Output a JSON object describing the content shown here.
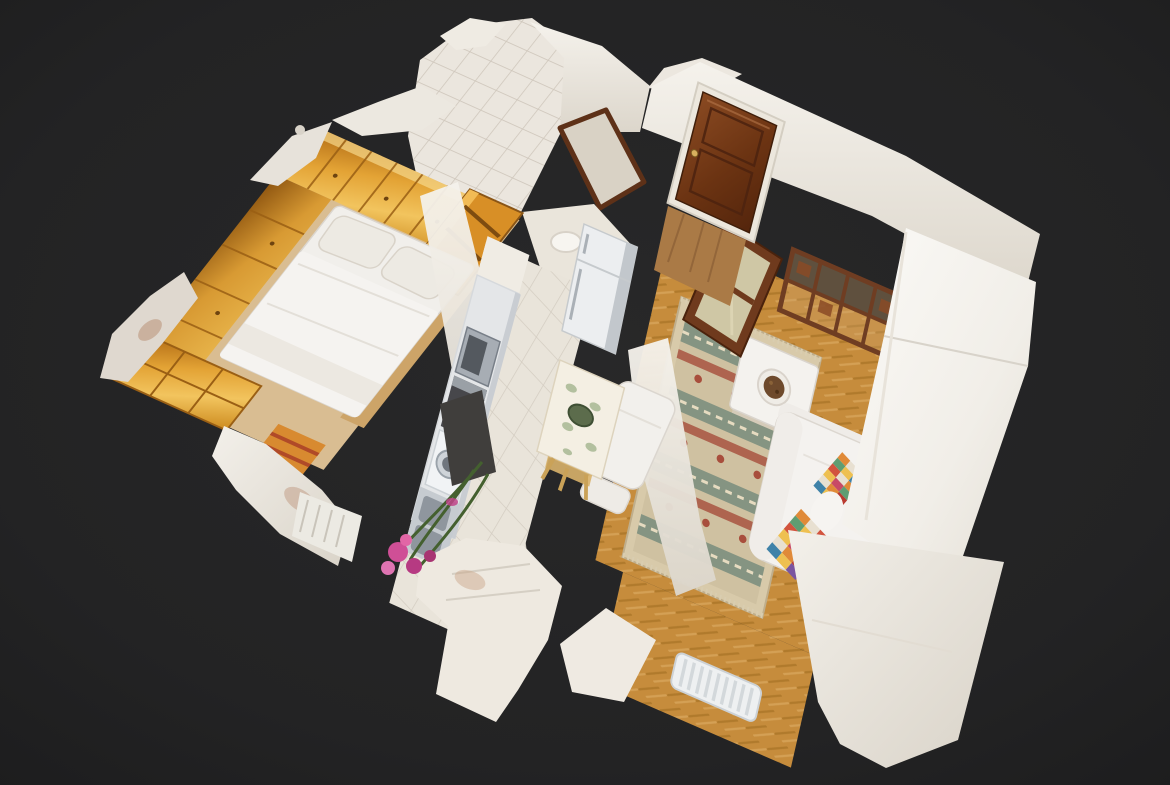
{
  "scene": {
    "aria_label": "3D dollhouse overhead view of a furnished one-bedroom apartment on a dark background",
    "view_mode": "dollhouse-3d",
    "background_color": "#232323",
    "rooms": [
      {
        "name": "bathroom",
        "objects": [
          "white tiled walls",
          "dark wood door frame",
          "washbasin"
        ]
      },
      {
        "name": "entry-hall",
        "objects": [
          "mahogany entrance door",
          "wood floor",
          "white walls"
        ]
      },
      {
        "name": "living-room",
        "objects": [
          "kilim rug",
          "white side table with bowl",
          "wooden shelving unit",
          "glazed wooden door",
          "white sofa with patchwork throws",
          "white armchair",
          "radiator",
          "herringbone parquet floor"
        ]
      },
      {
        "name": "bedroom",
        "objects": [
          "fitted honey-wood wardrobes",
          "open shelving unit",
          "double bed with white bedding",
          "chest of drawers",
          "bouquet of pink flowers"
        ]
      },
      {
        "name": "kitchen",
        "objects": [
          "fridge",
          "microwave",
          "oven",
          "washing machine",
          "stainless sink",
          "tiled floor",
          "dining table with floral tablecloth",
          "wooden chair"
        ]
      }
    ],
    "palette": {
      "background": "#232323",
      "wall_white": "#f2efe9",
      "wall_bright": "#fbfaf7",
      "wardrobe_wood": "#d8932c",
      "door_mahogany": "#6f3a1d",
      "parquet": "#c68c3c",
      "kitchen_tile": "#e9e4da",
      "bathroom_tile": "#ebe6de",
      "rug_green": "#7c8f7e",
      "rug_red": "#aa5a46",
      "rug_cream": "#d8caaa",
      "sofa_white": "#f4f2ef",
      "appliance_steel": "#c6cbd0",
      "flower_pink": "#cf4f96",
      "throw_colors": [
        "#d2543e",
        "#e08a38",
        "#eec051",
        "#5f9d72",
        "#3f82a8",
        "#c84a66",
        "#e8e0d1",
        "#7a55a0",
        "#b93b30"
      ]
    }
  }
}
